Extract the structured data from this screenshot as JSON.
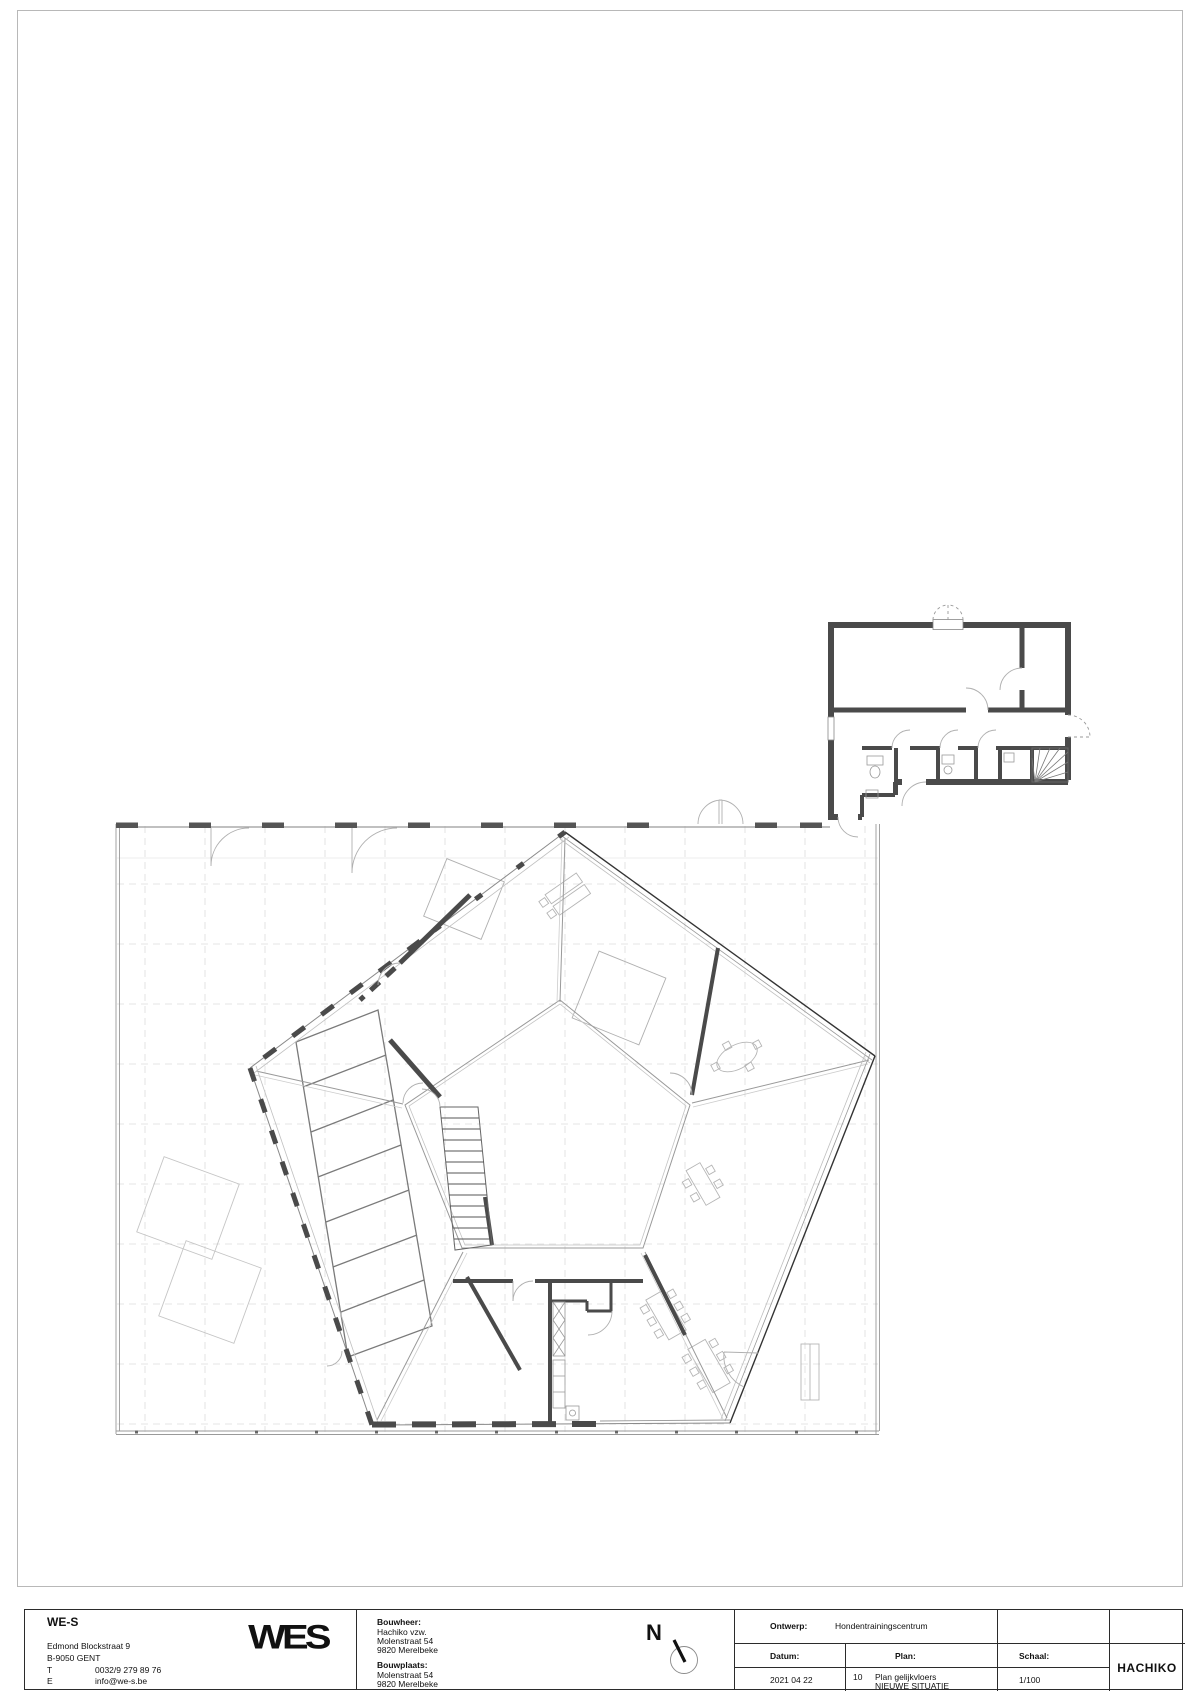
{
  "title_block": {
    "firm": {
      "name": "WE-S",
      "address1": "Edmond Blockstraat 9",
      "address2": "B-9050 GENT",
      "phone_label": "T",
      "phone": "0032/9 279 89 76",
      "email_label": "E",
      "email": "info@we-s.be",
      "logo_text": "WES"
    },
    "client": {
      "label": "Bouwheer:",
      "name": "Hachiko vzw.",
      "street": "Molenstraat 54",
      "city": "9820 Merelbeke"
    },
    "site": {
      "label": "Bouwplaats:",
      "street": "Molenstraat 54",
      "city": "9820 Merelbeke"
    },
    "north": {
      "label": "N"
    },
    "fields": {
      "ontwerp_label": "Ontwerp:",
      "ontwerp_value": "Hondentrainingscentrum",
      "datum_label": "Datum:",
      "datum_value": "2021 04 22",
      "plan_label": "Plan:",
      "plan_number": "10",
      "plan_line1": "Plan gelijkvloers",
      "plan_line2": "NIEUWE SITUATIE",
      "schaal_label": "Schaal:",
      "schaal_value": "1/100",
      "code": "HACHIKO"
    }
  },
  "drawing": {
    "type": "architectural floor plan, ground floor, new situation",
    "buildings": [
      "pentagonal training hall with inner pentagonal courtyard",
      "rectangular annex top-right"
    ]
  },
  "colors": {
    "wall_dark": "#4a4a4a",
    "line_mid": "#777777",
    "line_light": "#b5b5b5",
    "grid": "#dcdcdc",
    "text": "#111111"
  }
}
